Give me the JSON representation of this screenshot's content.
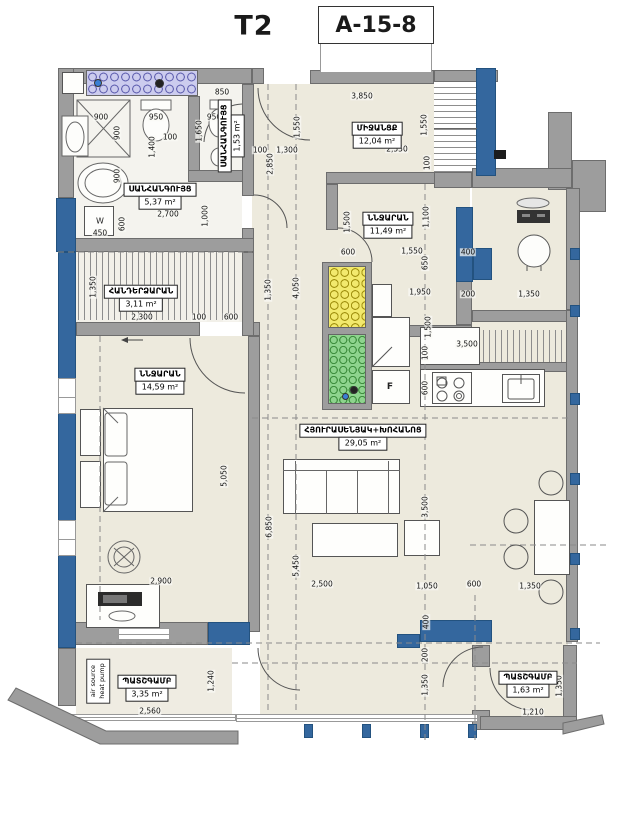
{
  "title": {
    "unit": "T2",
    "code": "A-15-8"
  },
  "rooms": [
    {
      "name": "ՍԱՆՀԱՆԳՈՒՅՑ",
      "area": "5,37 m²"
    },
    {
      "name": "ՍԱՆՀԱՆԳՈՒՅՑ",
      "area": "1,53 m²"
    },
    {
      "name": "ՄԻՋԱՆՑՔ",
      "area": "12,04 m²"
    },
    {
      "name": "ՆՆՋԱՐԱՆ",
      "area": "11,49 m²"
    },
    {
      "name": "ՀԱՆԴԵՐՁԱՐԱՆ",
      "area": "3,11 m²"
    },
    {
      "name": "ՆՆՋԱՐԱՆ",
      "area": "14,59 m²"
    },
    {
      "name": "ՀՅՈՒՐԱՍԵՆՅԱԿ+ԽՈՀԱՆՈՑ",
      "area": "29,05 m²"
    },
    {
      "name": "ՊԱՏՇԳԱՄԲ",
      "area": "3,35 m²"
    },
    {
      "name": "ՊԱՏՇԳԱՄԲ",
      "area": "1,63 m²"
    }
  ],
  "labels": {
    "heat_pump_line1": "air source",
    "heat_pump_line2": "heat pump",
    "fridge": "F",
    "w_mark": "W"
  },
  "colors": {
    "wall": "#9d9d9d",
    "column_blue": "#34679e",
    "floor_cream": "#edeadd",
    "shaft_purple": "#ccccee",
    "shaft_yellow": "#f2e96d",
    "shaft_green": "#8ed48e"
  },
  "dimensions": [
    {
      "t": "850",
      "x": 222,
      "y": 92
    },
    {
      "t": "900",
      "x": 101,
      "y": 117
    },
    {
      "t": "950",
      "x": 156,
      "y": 117
    },
    {
      "t": "950",
      "x": 214,
      "y": 117
    },
    {
      "t": "900",
      "x": 117,
      "y": 133,
      "v": 1
    },
    {
      "t": "100",
      "x": 170,
      "y": 137
    },
    {
      "t": "1,400",
      "x": 152,
      "y": 147,
      "v": 1
    },
    {
      "t": "1,650",
      "x": 199,
      "y": 131,
      "v": 1
    },
    {
      "t": "900",
      "x": 117,
      "y": 176,
      "v": 1
    },
    {
      "t": "2,700",
      "x": 168,
      "y": 214
    },
    {
      "t": "1,000",
      "x": 205,
      "y": 216,
      "v": 1
    },
    {
      "t": "600",
      "x": 122,
      "y": 224,
      "v": 1
    },
    {
      "t": "450",
      "x": 100,
      "y": 233
    },
    {
      "t": "3,850",
      "x": 362,
      "y": 96
    },
    {
      "t": "1,550",
      "x": 297,
      "y": 127,
      "v": 1
    },
    {
      "t": "1,550",
      "x": 424,
      "y": 125,
      "v": 1
    },
    {
      "t": "100",
      "x": 260,
      "y": 150
    },
    {
      "t": "1,300",
      "x": 287,
      "y": 150
    },
    {
      "t": "2,550",
      "x": 397,
      "y": 149
    },
    {
      "t": "2,850",
      "x": 270,
      "y": 164,
      "v": 1
    },
    {
      "t": "100",
      "x": 427,
      "y": 163,
      "v": 1
    },
    {
      "t": "1,500",
      "x": 347,
      "y": 222,
      "v": 1
    },
    {
      "t": "1,100",
      "x": 426,
      "y": 217,
      "v": 1
    },
    {
      "t": "600",
      "x": 348,
      "y": 252
    },
    {
      "t": "1,550",
      "x": 412,
      "y": 251
    },
    {
      "t": "400",
      "x": 468,
      "y": 252
    },
    {
      "t": "650",
      "x": 425,
      "y": 263,
      "v": 1
    },
    {
      "t": "1,950",
      "x": 420,
      "y": 292
    },
    {
      "t": "200",
      "x": 468,
      "y": 294
    },
    {
      "t": "1,350",
      "x": 529,
      "y": 294
    },
    {
      "t": "1,500",
      "x": 428,
      "y": 327,
      "v": 1
    },
    {
      "t": "3,500",
      "x": 467,
      "y": 344
    },
    {
      "t": "100",
      "x": 425,
      "y": 353,
      "v": 1
    },
    {
      "t": "600",
      "x": 425,
      "y": 388,
      "v": 1
    },
    {
      "t": "4,050",
      "x": 296,
      "y": 288,
      "v": 1
    },
    {
      "t": "1,350",
      "x": 268,
      "y": 290,
      "v": 1
    },
    {
      "t": "1,350",
      "x": 93,
      "y": 287,
      "v": 1
    },
    {
      "t": "2,300",
      "x": 142,
      "y": 317
    },
    {
      "t": "100",
      "x": 199,
      "y": 317
    },
    {
      "t": "600",
      "x": 231,
      "y": 317
    },
    {
      "t": "5,050",
      "x": 224,
      "y": 476,
      "v": 1
    },
    {
      "t": "6,850",
      "x": 269,
      "y": 527,
      "v": 1
    },
    {
      "t": "5,450",
      "x": 296,
      "y": 566,
      "v": 1
    },
    {
      "t": "3,500",
      "x": 425,
      "y": 507,
      "v": 1
    },
    {
      "t": "2,900",
      "x": 161,
      "y": 581
    },
    {
      "t": "2,500",
      "x": 322,
      "y": 584
    },
    {
      "t": "1,050",
      "x": 427,
      "y": 586
    },
    {
      "t": "600",
      "x": 474,
      "y": 584
    },
    {
      "t": "1,350",
      "x": 530,
      "y": 586
    },
    {
      "t": "1,240",
      "x": 211,
      "y": 681,
      "v": 1
    },
    {
      "t": "2,560",
      "x": 150,
      "y": 711
    },
    {
      "t": "400",
      "x": 426,
      "y": 622,
      "v": 1
    },
    {
      "t": "200",
      "x": 425,
      "y": 655,
      "v": 1
    },
    {
      "t": "1,350",
      "x": 425,
      "y": 685,
      "v": 1
    },
    {
      "t": "1,210",
      "x": 533,
      "y": 712
    },
    {
      "t": "1,350",
      "x": 559,
      "y": 686,
      "v": 1
    }
  ]
}
